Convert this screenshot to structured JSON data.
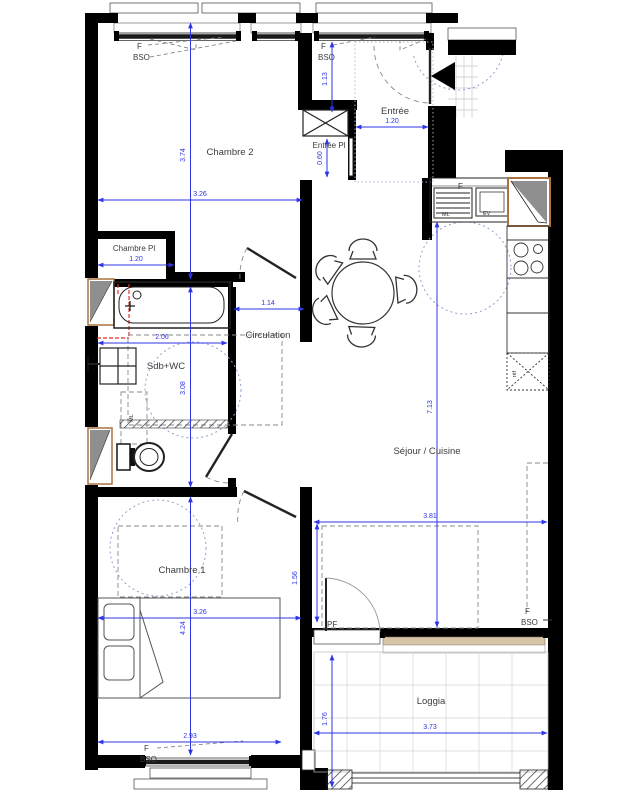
{
  "rooms": {
    "chambre2": "Chambre 2",
    "chambre_pl": "Chambre Pl",
    "sdb_wc": "Sdb+WC",
    "circulation": "Circulation",
    "entree": "Entrée",
    "entree_pl": "Entrée Pl",
    "sejour_cuisine": "Séjour / Cuisine",
    "chambre1": "Chambre 1",
    "loggia": "Loggia"
  },
  "dims": {
    "chambre2_h": "3.74",
    "chambre2_w": "3.26",
    "entree_win_h": "1.13",
    "entree_w": "1.20",
    "entree_pl_d": "0.60",
    "chambre_pl_w": "1.20",
    "circulation_w": "1.14",
    "sdb_w": "2.06",
    "sdb_h": "3.08",
    "sejour_h": "7.13",
    "sejour_w": "3.81",
    "chambre1_w": "3.26",
    "chambre1_h": "4.24",
    "sejour_right_h": "1.56",
    "chambre1_south": "2.93",
    "loggia_w": "3.73",
    "loggia_h": "1.76"
  },
  "window_labels": {
    "f": "F",
    "bso": "BSO",
    "pf": "PF"
  },
  "kitchen": {
    "f": "F",
    "ml": "ML",
    "ev": "EV",
    "ref": "réf"
  },
  "bathroom": {
    "ml": "ML"
  },
  "colors": {
    "dim_blue": "#2e35e6",
    "wall_black": "#000000",
    "wood_brown": "#a9743f",
    "sill_beige": "#d8c5a7",
    "turn_circle": "#8fa0cc",
    "red_mark": "#e03228"
  }
}
